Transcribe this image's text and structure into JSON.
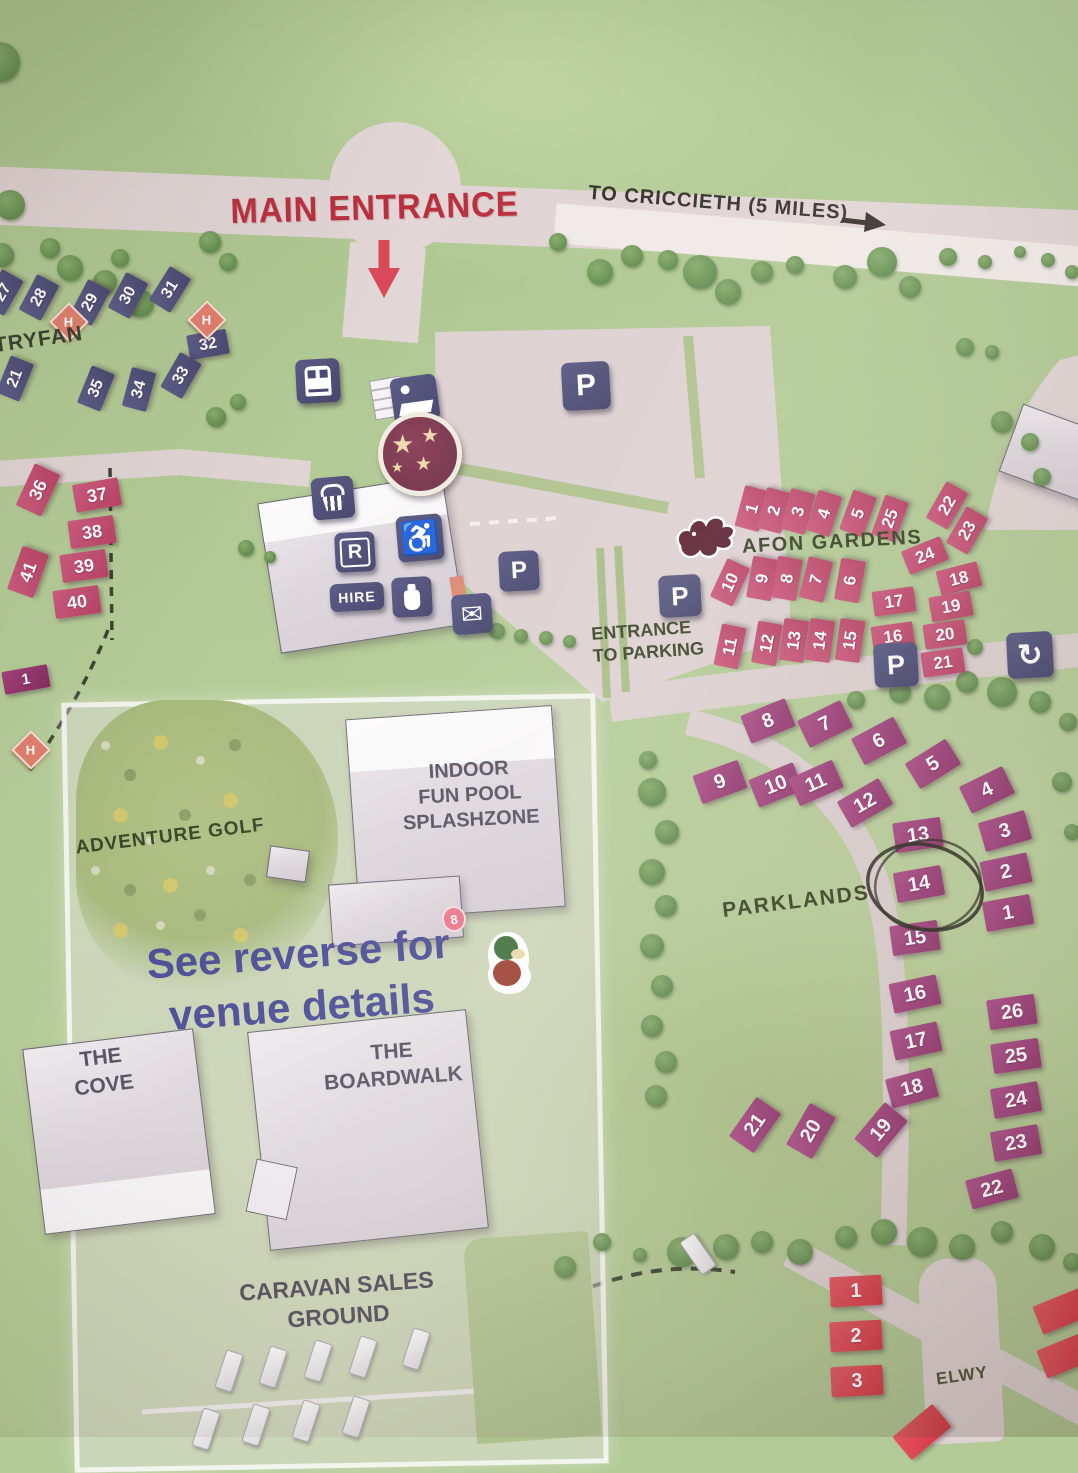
{
  "map": {
    "labels": {
      "main_entrance": "MAIN ENTRANCE",
      "to_criccieth": "TO CRICCIETH (5 MILES)",
      "tryfan": "TRYFAN",
      "afon_gardens": "AFON GARDENS",
      "entrance_to_parking": "ENTRANCE\nTO PARKING",
      "parklands": "PARKLANDS",
      "adventure_golf": "ADVENTURE GOLF",
      "pool": "INDOOR\nFUN POOL\nSPLASHZONE",
      "see_reverse": "See reverse for\nvenue details",
      "cove": "THE\nCOVE",
      "boardwalk": "THE\nBOARDWALK",
      "caravan_sales": "CARAVAN SALES\nGROUND",
      "elwy": "ELWY",
      "hire_sign": "HIRE",
      "reception_sign": "R",
      "parking_letter": "P"
    },
    "colors": {
      "field_green": "#b3cb97",
      "road": "#e0d4d4",
      "main_road_white": "#f0e9e7",
      "navy_plot": "#4d4d77",
      "crimson_plot": "#c24d72",
      "purple_plot": "#a04280",
      "red_plot": "#dd3e48",
      "sign_navy": "#4e4e78",
      "entrance_red": "#ba2f3d",
      "label_olive": "#3c4628",
      "see_reverse_blue": "#4b4e96",
      "h_marker": "#e07f6d",
      "dragon_maroon": "#5c2130"
    },
    "areas": [
      {
        "name": "tryfan",
        "palette": "navy",
        "w": 40,
        "h": 25,
        "fs": 16,
        "plots": [
          {
            "n": "27",
            "x": 3,
            "y": 292,
            "r": -60
          },
          {
            "n": "28",
            "x": 39,
            "y": 297,
            "r": -62
          },
          {
            "n": "29",
            "x": 90,
            "y": 302,
            "r": -62
          },
          {
            "n": "30",
            "x": 128,
            "y": 295,
            "r": -62
          },
          {
            "n": "31",
            "x": 170,
            "y": 289,
            "r": -58
          },
          {
            "n": "32",
            "x": 208,
            "y": 344,
            "r": -10
          },
          {
            "n": "21",
            "x": 15,
            "y": 378,
            "r": -68
          },
          {
            "n": "35",
            "x": 96,
            "y": 388,
            "r": -68
          },
          {
            "n": "34",
            "x": 139,
            "y": 389,
            "r": -75
          },
          {
            "n": "33",
            "x": 181,
            "y": 375,
            "r": -60
          }
        ]
      },
      {
        "name": "west-pitches",
        "palette": "crimson",
        "w": 46,
        "h": 28,
        "fs": 18,
        "plots": [
          {
            "n": "36",
            "x": 38,
            "y": 490,
            "r": -65
          },
          {
            "n": "37",
            "x": 97,
            "y": 495,
            "r": -10
          },
          {
            "n": "38",
            "x": 92,
            "y": 532,
            "r": -8
          },
          {
            "n": "39",
            "x": 84,
            "y": 566,
            "r": -8
          },
          {
            "n": "40",
            "x": 77,
            "y": 602,
            "r": -8
          },
          {
            "n": "41",
            "x": 28,
            "y": 572,
            "r": -70
          }
        ]
      },
      {
        "name": "west-edge",
        "palette": "magenta",
        "w": 46,
        "h": 23,
        "fs": 15,
        "plots": [
          {
            "n": "1",
            "x": 26,
            "y": 679,
            "r": -10
          }
        ]
      },
      {
        "name": "afon-gardens",
        "palette": "crimson",
        "w": 42,
        "h": 25,
        "fs": 17,
        "plots": [
          {
            "n": "1",
            "x": 752,
            "y": 508,
            "r": -75
          },
          {
            "n": "2",
            "x": 774,
            "y": 510,
            "r": -75
          },
          {
            "n": "3",
            "x": 798,
            "y": 511,
            "r": -75
          },
          {
            "n": "4",
            "x": 824,
            "y": 513,
            "r": -72
          },
          {
            "n": "5",
            "x": 858,
            "y": 513,
            "r": -70
          },
          {
            "n": "25",
            "x": 890,
            "y": 518,
            "r": -70
          },
          {
            "n": "22",
            "x": 947,
            "y": 505,
            "r": -60
          },
          {
            "n": "23",
            "x": 967,
            "y": 530,
            "r": -60
          },
          {
            "n": "24",
            "x": 925,
            "y": 555,
            "r": -22
          },
          {
            "n": "10",
            "x": 730,
            "y": 582,
            "r": -65
          },
          {
            "n": "9",
            "x": 762,
            "y": 578,
            "r": -80
          },
          {
            "n": "8",
            "x": 787,
            "y": 578,
            "r": -80
          },
          {
            "n": "7",
            "x": 816,
            "y": 579,
            "r": -76
          },
          {
            "n": "6",
            "x": 850,
            "y": 580,
            "r": -80
          },
          {
            "n": "18",
            "x": 959,
            "y": 578,
            "r": -14
          },
          {
            "n": "17",
            "x": 894,
            "y": 601,
            "r": -8
          },
          {
            "n": "19",
            "x": 951,
            "y": 606,
            "r": -10
          },
          {
            "n": "11",
            "x": 730,
            "y": 646,
            "r": -78
          },
          {
            "n": "12",
            "x": 767,
            "y": 643,
            "r": -80
          },
          {
            "n": "13",
            "x": 794,
            "y": 640,
            "r": -82
          },
          {
            "n": "14",
            "x": 820,
            "y": 640,
            "r": -82
          },
          {
            "n": "15",
            "x": 850,
            "y": 640,
            "r": -82
          },
          {
            "n": "16",
            "x": 893,
            "y": 636,
            "r": -8
          },
          {
            "n": "20",
            "x": 945,
            "y": 634,
            "r": -8
          },
          {
            "n": "21",
            "x": 943,
            "y": 662,
            "r": -8
          }
        ]
      },
      {
        "name": "parklands",
        "palette": "purple",
        "w": 48,
        "h": 30,
        "fs": 20,
        "plots": [
          {
            "n": "8",
            "x": 768,
            "y": 721,
            "r": -22
          },
          {
            "n": "7",
            "x": 825,
            "y": 724,
            "r": -26
          },
          {
            "n": "6",
            "x": 879,
            "y": 741,
            "r": -28
          },
          {
            "n": "5",
            "x": 933,
            "y": 764,
            "r": -32
          },
          {
            "n": "9",
            "x": 720,
            "y": 782,
            "r": -20
          },
          {
            "n": "10",
            "x": 776,
            "y": 785,
            "r": -22
          },
          {
            "n": "11",
            "x": 816,
            "y": 783,
            "r": -24
          },
          {
            "n": "12",
            "x": 865,
            "y": 803,
            "r": -30
          },
          {
            "n": "4",
            "x": 987,
            "y": 790,
            "r": -26
          },
          {
            "n": "3",
            "x": 1005,
            "y": 831,
            "r": -16
          },
          {
            "n": "13",
            "x": 918,
            "y": 835,
            "r": -8
          },
          {
            "n": "2",
            "x": 1006,
            "y": 872,
            "r": -12
          },
          {
            "n": "14",
            "x": 919,
            "y": 884,
            "r": -10
          },
          {
            "n": "1",
            "x": 1008,
            "y": 913,
            "r": -10
          },
          {
            "n": "15",
            "x": 915,
            "y": 938,
            "r": -8
          },
          {
            "n": "16",
            "x": 915,
            "y": 994,
            "r": -12
          },
          {
            "n": "17",
            "x": 916,
            "y": 1041,
            "r": -12
          },
          {
            "n": "18",
            "x": 912,
            "y": 1088,
            "r": -15
          },
          {
            "n": "21",
            "x": 755,
            "y": 1125,
            "r": -55
          },
          {
            "n": "20",
            "x": 811,
            "y": 1131,
            "r": -60
          },
          {
            "n": "19",
            "x": 881,
            "y": 1130,
            "r": -50
          },
          {
            "n": "26",
            "x": 1012,
            "y": 1012,
            "r": -8
          },
          {
            "n": "25",
            "x": 1016,
            "y": 1056,
            "r": -8
          },
          {
            "n": "24",
            "x": 1016,
            "y": 1100,
            "r": -10
          },
          {
            "n": "23",
            "x": 1016,
            "y": 1143,
            "r": -10
          },
          {
            "n": "22",
            "x": 992,
            "y": 1189,
            "r": -15
          }
        ]
      },
      {
        "name": "elwy",
        "palette": "red",
        "w": 52,
        "h": 30,
        "fs": 20,
        "plots": [
          {
            "n": "1",
            "x": 856,
            "y": 1291,
            "r": -3
          },
          {
            "n": "2",
            "x": 856,
            "y": 1336,
            "r": -3
          },
          {
            "n": "3",
            "x": 857,
            "y": 1381,
            "r": -3
          },
          {
            "n": "",
            "x": 1062,
            "y": 1311,
            "r": -22
          },
          {
            "n": "",
            "x": 1066,
            "y": 1355,
            "r": -22
          },
          {
            "n": "",
            "x": 922,
            "y": 1432,
            "r": -40
          }
        ]
      }
    ],
    "parking_signs": [
      {
        "x": 586,
        "y": 386,
        "s": 48,
        "fs": 30
      },
      {
        "x": 519,
        "y": 571,
        "s": 40,
        "fs": 24
      },
      {
        "x": 680,
        "y": 596,
        "s": 42,
        "fs": 26
      },
      {
        "x": 896,
        "y": 665,
        "s": 44,
        "fs": 27
      }
    ],
    "h_markers": [
      {
        "x": 67,
        "y": 320
      },
      {
        "x": 205,
        "y": 318
      },
      {
        "x": 29,
        "y": 748
      }
    ],
    "trees": [
      {
        "x": 10,
        "y": 205,
        "d": 30
      },
      {
        "x": 2,
        "y": 255,
        "d": 24
      },
      {
        "x": 50,
        "y": 248,
        "d": 20
      },
      {
        "x": 70,
        "y": 268,
        "d": 26
      },
      {
        "x": 105,
        "y": 282,
        "d": 24
      },
      {
        "x": 140,
        "y": 303,
        "d": 28
      },
      {
        "x": 168,
        "y": 288,
        "d": 20
      },
      {
        "x": 210,
        "y": 242,
        "d": 22
      },
      {
        "x": 228,
        "y": 262,
        "d": 18
      },
      {
        "x": 120,
        "y": 258,
        "d": 18
      },
      {
        "x": 0,
        "y": 62,
        "d": 40
      },
      {
        "x": 558,
        "y": 242,
        "d": 18
      },
      {
        "x": 600,
        "y": 272,
        "d": 26
      },
      {
        "x": 632,
        "y": 256,
        "d": 22
      },
      {
        "x": 668,
        "y": 260,
        "d": 20
      },
      {
        "x": 700,
        "y": 272,
        "d": 34
      },
      {
        "x": 728,
        "y": 292,
        "d": 26
      },
      {
        "x": 762,
        "y": 272,
        "d": 22
      },
      {
        "x": 795,
        "y": 265,
        "d": 18
      },
      {
        "x": 845,
        "y": 277,
        "d": 24
      },
      {
        "x": 882,
        "y": 262,
        "d": 30
      },
      {
        "x": 910,
        "y": 287,
        "d": 22
      },
      {
        "x": 948,
        "y": 257,
        "d": 18
      },
      {
        "x": 985,
        "y": 262,
        "d": 14
      },
      {
        "x": 1020,
        "y": 252,
        "d": 12
      },
      {
        "x": 1048,
        "y": 260,
        "d": 14
      },
      {
        "x": 1072,
        "y": 272,
        "d": 14
      },
      {
        "x": 965,
        "y": 347,
        "d": 18
      },
      {
        "x": 992,
        "y": 352,
        "d": 14
      },
      {
        "x": 1002,
        "y": 422,
        "d": 22
      },
      {
        "x": 1030,
        "y": 442,
        "d": 18
      },
      {
        "x": 1042,
        "y": 477,
        "d": 18
      },
      {
        "x": 856,
        "y": 700,
        "d": 18
      },
      {
        "x": 900,
        "y": 692,
        "d": 22
      },
      {
        "x": 937,
        "y": 697,
        "d": 26
      },
      {
        "x": 967,
        "y": 682,
        "d": 22
      },
      {
        "x": 1002,
        "y": 692,
        "d": 30
      },
      {
        "x": 1040,
        "y": 702,
        "d": 22
      },
      {
        "x": 1068,
        "y": 722,
        "d": 18
      },
      {
        "x": 975,
        "y": 647,
        "d": 16
      },
      {
        "x": 648,
        "y": 760,
        "d": 18
      },
      {
        "x": 652,
        "y": 792,
        "d": 28
      },
      {
        "x": 667,
        "y": 832,
        "d": 24
      },
      {
        "x": 652,
        "y": 872,
        "d": 26
      },
      {
        "x": 666,
        "y": 906,
        "d": 22
      },
      {
        "x": 652,
        "y": 946,
        "d": 24
      },
      {
        "x": 662,
        "y": 986,
        "d": 22
      },
      {
        "x": 652,
        "y": 1026,
        "d": 22
      },
      {
        "x": 666,
        "y": 1062,
        "d": 22
      },
      {
        "x": 656,
        "y": 1096,
        "d": 22
      },
      {
        "x": 497,
        "y": 631,
        "d": 16
      },
      {
        "x": 521,
        "y": 636,
        "d": 14
      },
      {
        "x": 546,
        "y": 638,
        "d": 14
      },
      {
        "x": 569,
        "y": 641,
        "d": 13
      },
      {
        "x": 246,
        "y": 548,
        "d": 16
      },
      {
        "x": 270,
        "y": 557,
        "d": 12
      },
      {
        "x": 216,
        "y": 417,
        "d": 20
      },
      {
        "x": 238,
        "y": 402,
        "d": 16
      },
      {
        "x": 565,
        "y": 1267,
        "d": 22
      },
      {
        "x": 602,
        "y": 1242,
        "d": 18
      },
      {
        "x": 640,
        "y": 1255,
        "d": 14
      },
      {
        "x": 682,
        "y": 1252,
        "d": 30
      },
      {
        "x": 726,
        "y": 1247,
        "d": 26
      },
      {
        "x": 762,
        "y": 1242,
        "d": 22
      },
      {
        "x": 800,
        "y": 1252,
        "d": 26
      },
      {
        "x": 846,
        "y": 1237,
        "d": 22
      },
      {
        "x": 884,
        "y": 1232,
        "d": 26
      },
      {
        "x": 922,
        "y": 1242,
        "d": 30
      },
      {
        "x": 962,
        "y": 1247,
        "d": 26
      },
      {
        "x": 1002,
        "y": 1232,
        "d": 22
      },
      {
        "x": 1042,
        "y": 1247,
        "d": 26
      },
      {
        "x": 1072,
        "y": 1262,
        "d": 18
      },
      {
        "x": 1062,
        "y": 782,
        "d": 20
      },
      {
        "x": 1072,
        "y": 832,
        "d": 16
      }
    ],
    "caravans": [
      {
        "x": 228,
        "y": 1370,
        "r": 18
      },
      {
        "x": 272,
        "y": 1366,
        "r": 18
      },
      {
        "x": 317,
        "y": 1360,
        "r": 18
      },
      {
        "x": 362,
        "y": 1356,
        "r": 18
      },
      {
        "x": 415,
        "y": 1348,
        "r": 18
      },
      {
        "x": 205,
        "y": 1428,
        "r": 18
      },
      {
        "x": 255,
        "y": 1424,
        "r": 18
      },
      {
        "x": 305,
        "y": 1420,
        "r": 18
      },
      {
        "x": 355,
        "y": 1416,
        "r": 18
      },
      {
        "x": 697,
        "y": 1253,
        "r": -35
      }
    ],
    "golf_dots": [
      {
        "x": 105,
        "y": 745
      },
      {
        "x": 130,
        "y": 775
      },
      {
        "x": 160,
        "y": 742
      },
      {
        "x": 200,
        "y": 760
      },
      {
        "x": 235,
        "y": 745
      },
      {
        "x": 120,
        "y": 815
      },
      {
        "x": 150,
        "y": 840
      },
      {
        "x": 185,
        "y": 815
      },
      {
        "x": 230,
        "y": 800
      },
      {
        "x": 95,
        "y": 870
      },
      {
        "x": 130,
        "y": 890
      },
      {
        "x": 170,
        "y": 885
      },
      {
        "x": 210,
        "y": 870
      },
      {
        "x": 250,
        "y": 880
      },
      {
        "x": 120,
        "y": 930
      },
      {
        "x": 160,
        "y": 925
      },
      {
        "x": 200,
        "y": 915
      },
      {
        "x": 240,
        "y": 935
      }
    ]
  }
}
